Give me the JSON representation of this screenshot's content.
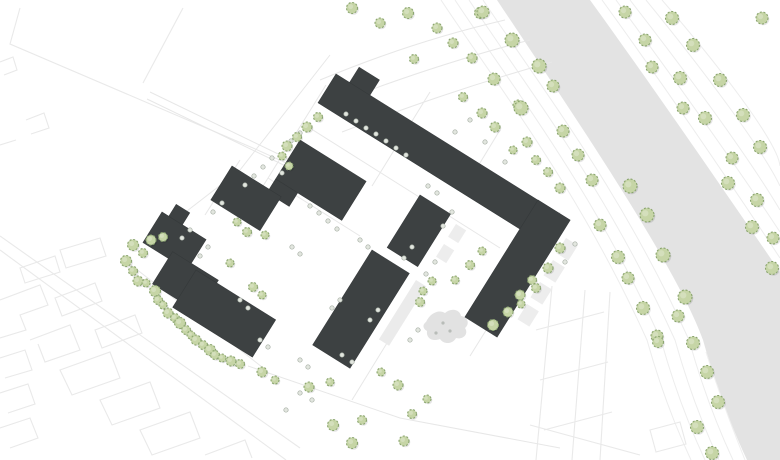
{
  "canvas": {
    "width": 780,
    "height": 460,
    "background": "#ffffff"
  },
  "colors": {
    "building_fill": "#3d4142",
    "building_stroke": "#343839",
    "tree_fill": "#c6d5a6",
    "tree_stroke": "#8ba570",
    "tree_shadow": "rgba(0,0,0,0.10)",
    "shrub_fill": "#e2e6df",
    "shrub_stroke": "#a7afa5",
    "river_band": "#e3e3e3",
    "contour_line": "#ededed",
    "context_line": "#e9e9e9",
    "street_line": "#e7e7e7",
    "parcel_line": "#ececec",
    "terrace_fill": "#ededed",
    "court_strip_fill": "#ebebeb",
    "playground_fill": "#e2e2e2",
    "playground_dot": "#b8bcb8",
    "band_inner_line": "#efefef"
  },
  "river_band": {
    "path": "M590,0 C648,80 710,170 780,272 L780,460 L747,460 C733,430 717,390 703,340 C675,262 560,95 497,0 Z"
  },
  "contours": {
    "left": [
      "M483,0 C546,95 621,190 689,340 C703,390 719,430 733,460",
      "M469,0 C532,95 607,190 675,340 C689,390 705,430 719,460",
      "M455,0 C518,95 593,190 661,340 C675,390 691,430 705,460",
      "M441,0 C504,95 579,190 647,340 C661,390 677,430 691,460"
    ],
    "right": [
      "M602,0 C660,80 722,170 780,258",
      "M616,0 C672,76 734,162 780,232",
      "M630,0 C686,72 748,156 780,210",
      "M646,0 C700,66 762,148 780,186",
      "M662,0 C716,62 778,142 780,166"
    ],
    "inner": [
      "M706,352 C720,396 733,430 745,460"
    ]
  },
  "context_lines": [
    "M0,236 L300,448",
    "M0,250 L286,460",
    "M0,300 L40,285 L48,305 L20,315 L26,330 L0,338",
    "M30,340 L70,325 L80,350 L45,362 L38,344",
    "M60,370 L110,352 L120,378 L72,395 Z",
    "M100,400 L150,382 L160,408 L112,425 Z",
    "M140,430 L190,412 L200,438 L152,455 Z",
    "M55,298 L95,283 L102,301 L62,316 Z",
    "M95,330 L135,315 L142,333 L102,348 Z",
    "M0,358 L25,350 L32,370 L5,378",
    "M0,393 L28,384 L35,404 L8,413",
    "M0,428 L30,418 L38,438 L10,448",
    "M60,250 L100,238 L106,256 L66,268 Z",
    "M20,268 L55,256 L60,272 L25,283 Z",
    "M205,455 L245,440 L252,458",
    "M20,8 L10,44 L253,148 L335,185",
    "M183,8 L143,83",
    "M0,62 L13,57 L17,70 L4,75",
    "M26,120 L44,113 L49,128 L31,134",
    "M0,145 L16,140",
    "M552,286 L536,460",
    "M585,290 L572,460",
    "M610,292 L600,460",
    "M536,330 L604,312",
    "M540,380 L608,362",
    "M544,430 L612,412",
    "M650,430 L680,422 L686,444 L656,452 Z",
    "M530,425 L640,455"
  ],
  "street_lines": [
    "M305,125 L500,248",
    "M268,178 L360,236",
    "M122,258 L262,367",
    "M248,366 L400,418 L560,448",
    "M326,85 L250,207",
    "M240,160 L205,215",
    "M430,92 L372,186",
    "M500,130 L472,176",
    "M560,212 L470,356",
    "M395,330 L352,400",
    "M330,55 L240,170 L152,238",
    "M150,92 L332,180",
    "M147,99 L329,187",
    "M320,80 C380,55 440,35 505,20",
    "M330,105 C395,80 460,58 530,40",
    "M342,132 C405,108 470,85 552,62"
  ],
  "buildings": [
    {
      "id": "north-long-bar",
      "x": 336,
      "y": 74,
      "angle": 32,
      "parts": [
        [
          0,
          0,
          240,
          34
        ],
        [
          16,
          -18,
          24,
          18
        ]
      ]
    },
    {
      "id": "north-center-block",
      "x": 300,
      "y": 140,
      "angle": 32,
      "parts": [
        [
          0,
          0,
          78,
          46
        ],
        [
          0,
          46,
          26,
          16
        ]
      ]
    },
    {
      "id": "west-small-block",
      "x": 232,
      "y": 166,
      "angle": 32,
      "parts": [
        [
          0,
          0,
          58,
          40
        ]
      ]
    },
    {
      "id": "west-zigzag-block",
      "x": 162,
      "y": 212,
      "angle": 32,
      "parts": [
        [
          0,
          0,
          52,
          36
        ],
        [
          30,
          28,
          54,
          38
        ],
        [
          8,
          -14,
          16,
          14
        ]
      ]
    },
    {
      "id": "southwest-slab",
      "x": 196,
      "y": 270,
      "angle": 32,
      "parts": [
        [
          0,
          0,
          94,
          44
        ]
      ]
    },
    {
      "id": "east-long-slab",
      "x": 538,
      "y": 200,
      "angle": 122,
      "parts": [
        [
          0,
          -38,
          138,
          38
        ]
      ]
    },
    {
      "id": "mid-small-slab",
      "x": 420,
      "y": 195,
      "angle": 122,
      "parts": [
        [
          0,
          -36,
          62,
          36
        ]
      ]
    },
    {
      "id": "south-center-slab",
      "x": 372,
      "y": 250,
      "angle": 122,
      "parts": [
        [
          0,
          -44,
          112,
          44
        ]
      ]
    }
  ],
  "light_structures": [
    {
      "x": 566,
      "y": 238,
      "angle": 122,
      "rect": [
        0,
        -14,
        18,
        14
      ],
      "fill": "terrace_fill"
    },
    {
      "x": 553,
      "y": 260,
      "angle": 122,
      "rect": [
        0,
        -14,
        18,
        14
      ],
      "fill": "terrace_fill"
    },
    {
      "x": 540,
      "y": 282,
      "angle": 122,
      "rect": [
        0,
        -14,
        18,
        14
      ],
      "fill": "terrace_fill"
    },
    {
      "x": 527,
      "y": 304,
      "angle": 122,
      "rect": [
        0,
        -14,
        18,
        14
      ],
      "fill": "terrace_fill"
    },
    {
      "x": 456,
      "y": 224,
      "angle": 122,
      "rect": [
        0,
        -12,
        15,
        12
      ],
      "fill": "terrace_fill"
    },
    {
      "x": 444,
      "y": 244,
      "angle": 122,
      "rect": [
        0,
        -12,
        15,
        12
      ],
      "fill": "terrace_fill"
    },
    {
      "x": 416,
      "y": 280,
      "angle": 122,
      "rect": [
        0,
        -12,
        70,
        12
      ],
      "fill": "court_strip_fill"
    },
    {
      "x": 358,
      "y": 96,
      "angle": 32,
      "rect": [
        0,
        0,
        26,
        18
      ],
      "fill": "terrace_fill"
    }
  ],
  "playground": {
    "path": "M426,322 c4,-9 13,-13 19,-9 c7,-6 15,-3 16,3 c7,1 9,8 4,12 c4,6 -2,12 -9,10 c-3,6 -12,7 -16,1 c-8,3 -14,-1 -13,-8 c-5,-3 -4,-7 -1,-9 Z",
    "dots": [
      [
        443,
        323
      ],
      [
        450,
        331
      ],
      [
        436,
        333
      ]
    ]
  },
  "trees": {
    "band_left": [
      [
        483,
        12,
        6
      ],
      [
        494,
        79,
        6
      ],
      [
        512,
        40,
        7
      ],
      [
        539,
        66,
        7
      ],
      [
        553,
        86,
        6
      ],
      [
        521,
        108,
        7
      ],
      [
        563,
        131,
        6
      ],
      [
        578,
        155,
        6
      ],
      [
        592,
        180,
        6
      ],
      [
        600,
        225,
        6
      ],
      [
        618,
        257,
        6.5
      ],
      [
        628,
        278,
        6
      ],
      [
        643,
        308,
        6.5
      ],
      [
        630,
        186,
        7
      ],
      [
        647,
        215,
        7
      ],
      [
        663,
        255,
        7
      ],
      [
        685,
        297,
        7
      ],
      [
        678,
        316,
        6
      ],
      [
        657,
        336,
        6
      ],
      [
        693,
        343,
        6.5
      ],
      [
        658,
        342,
        5.5
      ],
      [
        707,
        372,
        6.5
      ],
      [
        718,
        402,
        6.5
      ],
      [
        697,
        427,
        6.5
      ],
      [
        712,
        453,
        6.5
      ]
    ],
    "band_right": [
      [
        625,
        12,
        6
      ],
      [
        672,
        18,
        6.5
      ],
      [
        645,
        40,
        6
      ],
      [
        693,
        45,
        6.5
      ],
      [
        652,
        67,
        6
      ],
      [
        680,
        78,
        6.5
      ],
      [
        720,
        80,
        6.5
      ],
      [
        683,
        108,
        6
      ],
      [
        705,
        118,
        6.5
      ],
      [
        743,
        115,
        6.5
      ],
      [
        762,
        18,
        6
      ],
      [
        760,
        147,
        6.5
      ],
      [
        732,
        158,
        6
      ],
      [
        728,
        183,
        6.5
      ],
      [
        757,
        200,
        6.5
      ],
      [
        752,
        227,
        6.5
      ],
      [
        773,
        238,
        6
      ],
      [
        772,
        268,
        6.5
      ]
    ],
    "boundary_row": [
      [
        151,
        240,
        5
      ],
      [
        163,
        237,
        4.5
      ],
      [
        133,
        245,
        5.5
      ],
      [
        143,
        253,
        4.5
      ],
      [
        126,
        261,
        5.5
      ],
      [
        133,
        271,
        4.5
      ],
      [
        138,
        281,
        5
      ],
      [
        146,
        283,
        4
      ],
      [
        155,
        291,
        5.5
      ],
      [
        158,
        300,
        4.5
      ],
      [
        163,
        305,
        4
      ],
      [
        168,
        313,
        5
      ],
      [
        175,
        318,
        4.5
      ],
      [
        180,
        323,
        5.5
      ],
      [
        186,
        330,
        4.5
      ],
      [
        191,
        335,
        4
      ],
      [
        196,
        340,
        5
      ],
      [
        203,
        345,
        4.5
      ],
      [
        210,
        350,
        5.5
      ],
      [
        215,
        355,
        4.5
      ],
      [
        222,
        358,
        4
      ],
      [
        231,
        361,
        5
      ],
      [
        240,
        364,
        4.5
      ]
    ],
    "site": [
      [
        318,
        117,
        4.5
      ],
      [
        307,
        127,
        5
      ],
      [
        297,
        137,
        4.5
      ],
      [
        287,
        146,
        5
      ],
      [
        282,
        156,
        4
      ],
      [
        289,
        166,
        4
      ],
      [
        352,
        8,
        5.5
      ],
      [
        380,
        23,
        5
      ],
      [
        408,
        13,
        5.5
      ],
      [
        437,
        28,
        5
      ],
      [
        453,
        43,
        5
      ],
      [
        480,
        13,
        5.5
      ],
      [
        472,
        58,
        5
      ],
      [
        414,
        59,
        4.5
      ],
      [
        463,
        97,
        4.5
      ],
      [
        482,
        113,
        5
      ],
      [
        495,
        127,
        5
      ],
      [
        518,
        105,
        5
      ],
      [
        527,
        142,
        5
      ],
      [
        513,
        150,
        4
      ],
      [
        536,
        160,
        4.5
      ],
      [
        548,
        172,
        4.5
      ],
      [
        560,
        188,
        5
      ],
      [
        237,
        222,
        4
      ],
      [
        247,
        232,
        4.5
      ],
      [
        230,
        263,
        4
      ],
      [
        265,
        235,
        4
      ],
      [
        253,
        287,
        4.5
      ],
      [
        262,
        295,
        4
      ],
      [
        262,
        372,
        5
      ],
      [
        275,
        380,
        4
      ],
      [
        309,
        387,
        5
      ],
      [
        330,
        382,
        4
      ],
      [
        333,
        425,
        5.5
      ],
      [
        352,
        443,
        5.5
      ],
      [
        362,
        420,
        4.5
      ],
      [
        381,
        372,
        4
      ],
      [
        398,
        385,
        5
      ],
      [
        404,
        441,
        5
      ],
      [
        412,
        414,
        4.5
      ],
      [
        427,
        399,
        4
      ],
      [
        493,
        325,
        5.5
      ],
      [
        508,
        312,
        5
      ],
      [
        520,
        295,
        5
      ],
      [
        532,
        280,
        4.5
      ],
      [
        560,
        248,
        5
      ],
      [
        548,
        268,
        5
      ],
      [
        536,
        288,
        4.5
      ],
      [
        521,
        304,
        4
      ],
      [
        470,
        265,
        4.5
      ],
      [
        455,
        280,
        4
      ],
      [
        482,
        251,
        4
      ],
      [
        423,
        291,
        4
      ],
      [
        420,
        302,
        4.5
      ],
      [
        432,
        281,
        4
      ]
    ]
  },
  "shrubs": [
    [
      346,
      114
    ],
    [
      356,
      121
    ],
    [
      366,
      128
    ],
    [
      376,
      134
    ],
    [
      386,
      141
    ],
    [
      396,
      148
    ],
    [
      406,
      155
    ],
    [
      300,
      133
    ],
    [
      291,
      141
    ],
    [
      272,
      158
    ],
    [
      263,
      167
    ],
    [
      254,
      176
    ],
    [
      245,
      185
    ],
    [
      222,
      203
    ],
    [
      213,
      212
    ],
    [
      282,
      173
    ],
    [
      310,
      206
    ],
    [
      319,
      213
    ],
    [
      328,
      221
    ],
    [
      337,
      229
    ],
    [
      200,
      256
    ],
    [
      208,
      247
    ],
    [
      292,
      247
    ],
    [
      300,
      254
    ],
    [
      360,
      240
    ],
    [
      368,
      247
    ],
    [
      428,
      186
    ],
    [
      437,
      193
    ],
    [
      412,
      247
    ],
    [
      404,
      258
    ],
    [
      340,
      300
    ],
    [
      332,
      308
    ],
    [
      260,
      340
    ],
    [
      268,
      347
    ],
    [
      300,
      360
    ],
    [
      308,
      367
    ],
    [
      470,
      120
    ],
    [
      455,
      132
    ],
    [
      485,
      142
    ],
    [
      505,
      162
    ],
    [
      452,
      212
    ],
    [
      443,
      226
    ],
    [
      435,
      262
    ],
    [
      426,
      274
    ],
    [
      378,
      310
    ],
    [
      370,
      320
    ],
    [
      575,
      244
    ],
    [
      565,
      262
    ],
    [
      300,
      393
    ],
    [
      312,
      400
    ],
    [
      286,
      410
    ],
    [
      342,
      355
    ],
    [
      352,
      362
    ],
    [
      418,
      330
    ],
    [
      410,
      340
    ],
    [
      240,
      300
    ],
    [
      248,
      308
    ],
    [
      190,
      230
    ],
    [
      182,
      238
    ]
  ]
}
